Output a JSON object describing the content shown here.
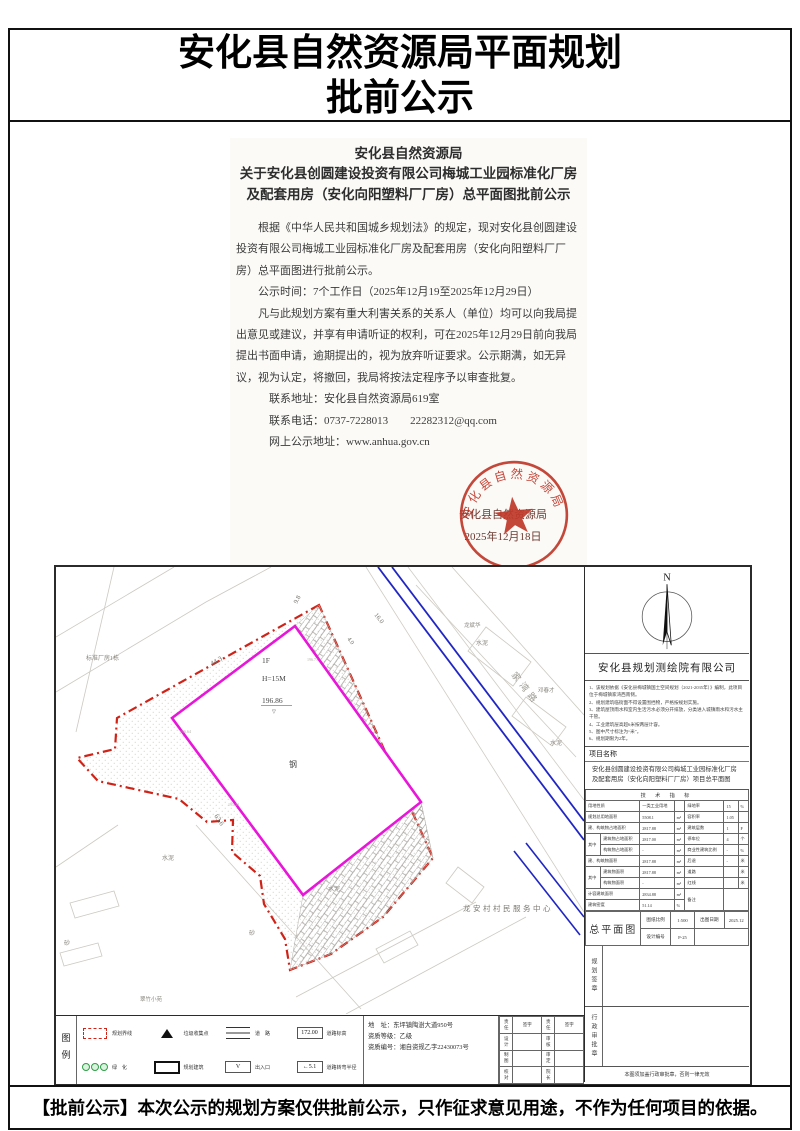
{
  "colors": {
    "magenta": "#e816d8",
    "boundary_red": "#d02318",
    "road_blue": "#2026c4",
    "seal_red": "#c0392b"
  },
  "page": {
    "title_line1": "安化县自然资源局平面规划",
    "title_line2": "批前公示",
    "footer": "【批前公示】本次公示的规划方案仅供批前公示，只作征求意见用途，不作为任何项目的依据。"
  },
  "notice": {
    "org": "安化县自然资源局",
    "subject": "关于安化县创圆建设投资有限公司梅城工业园标准化厂房及配套用房（安化向阳塑料厂厂房）总平面图批前公示",
    "paragraphs": [
      "根据《中华人民共和国城乡规划法》的规定，现对安化县创圆建设投资有限公司梅城工业园标准化厂房及配套用房（安化向阳塑料厂厂房）总平面图进行批前公示。",
      "公示时间：7个工作日（2025年12月19至2025年12月29日）",
      "凡与此规划方案有重大利害关系的关系人（单位）均可以向我局提出意见或建议，并享有申请听证的权利，可在2025年12月29日前向我局提出书面申请，逾期提出的，视为放弃听证要求。公示期满，如无异议，视为认定，将撤回，我局将按法定程序予以审查批复。"
    ],
    "contact_address": "联系地址：安化县自然资源局619室",
    "contact_phone": "联系电话：0737-7228013　　22282312@qq.com",
    "online_url": "网上公示地址：www.anhua.gov.cn",
    "issuer": "安化县自然资源局",
    "date": "2025年12月18日",
    "seal_text": "安化县自然资源局"
  },
  "plan": {
    "labels": [
      "1F",
      "H=15M",
      "196.86",
      "钢",
      "水泥",
      "水泥",
      "水泥",
      "水泥",
      "砂",
      "砂",
      "龙安村村民服务中心",
      "标准厂房1栋",
      "翠竹小苑",
      "龙斌华",
      "邓春才",
      "家湾路",
      "44.3",
      "9.8",
      "16.0",
      "4.0",
      "63.6",
      "196.71",
      "196.64",
      "195.23",
      "▽"
    ]
  },
  "titleblock": {
    "north_label": "N",
    "company": "安化县规划测绘院有限公司",
    "notes": [
      "1、该规划依据《安化县梅城镇国土空间规划（2021-2035年）》编制，此项目位于梅城镇家湾西南侧。",
      "2、规划建筑临街面不得设置围挡物，严格按规划实施。",
      "3、建筑屋顶雨水和室内生活污水必须分开排放，分类进入城镇雨水和污水主干管。",
      "4、工业建筑层高超6米按两层计容。",
      "5、图中尺寸标注为“米”。",
      "6、规划期限为2年。"
    ],
    "project_label": "项目名称",
    "project_name": "安化县创圆建设投资有限公司梅城工业园标准化厂房及配套用房（安化向阳塑料厂厂房）项目总平面图",
    "table": {
      "header": "技 术 指 标",
      "qizhong": "其中",
      "left": [
        {
          "l": "用地性质",
          "v": "一类工业用地",
          "u": ""
        },
        {
          "l": "规划总用地面积",
          "v": "5508.1",
          "u": "m²"
        },
        {
          "l": "建、构筑物占地面积",
          "v": "2817.88",
          "u": "m²"
        },
        {
          "l": "建筑物占地面积",
          "v": "2817.00",
          "u": "m²"
        },
        {
          "l": "构筑物占地面积",
          "v": "-",
          "u": "m²"
        },
        {
          "l": "建、构筑物面积",
          "v": "2817.88",
          "u": "m²"
        },
        {
          "l": "建筑物面积",
          "v": "2817.88",
          "u": "m²"
        },
        {
          "l": "构筑物面积",
          "v": "-",
          "u": "m²"
        },
        {
          "l": "计容建筑面积",
          "v": "2834.88",
          "u": "m²"
        },
        {
          "l": "建筑密度",
          "v": "51.14",
          "u": "%"
        }
      ],
      "right": [
        {
          "l": "绿地率",
          "v": "15",
          "u": "%"
        },
        {
          "l": "容积率",
          "v": "1.05",
          "u": ""
        },
        {
          "l": "建筑层数",
          "v": "1",
          "u": "F"
        },
        {
          "l": "停车位",
          "v": "4",
          "u": "个"
        },
        {
          "l": "商业性建筑比例",
          "v": "-",
          "u": "%"
        },
        {
          "l": "后退",
          "v": "-",
          "u": "米"
        },
        {
          "l": "道路",
          "v": "",
          "u": "米"
        },
        {
          "l": "红线",
          "v": "",
          "u": "米"
        },
        {
          "l": "备注",
          "v": "",
          "u": ""
        }
      ]
    },
    "drawing": {
      "name": "总平面图",
      "scale_label": "图纸比例",
      "scale": "1:500",
      "date_label": "出图日期",
      "date": "2025.12",
      "no_label": "设计编号",
      "no": "P-25"
    },
    "plan_seal": "规划签章",
    "admin_seal": "行政审批章",
    "invalid_note": "本图须加盖行政审批章，否则一律无效"
  },
  "legend": {
    "title": "图例",
    "items": [
      {
        "label": "规划界线"
      },
      {
        "label": "绿　化"
      },
      {
        "label": "垃圾收集点"
      },
      {
        "label": "规划建筑"
      },
      {
        "label": "道　路"
      },
      {
        "label": "出入口"
      },
      {
        "label": "道路标高"
      },
      {
        "label": "道路转弯半径"
      }
    ],
    "elev_value": "172.00",
    "radius_value": "←5.1",
    "entrance_glyph": "V",
    "address": "地　址：东坪镇陶澍大道950号",
    "grade": "资质等级：乙级",
    "cert": "资质编号：湘自资规乙字22430073号",
    "signoff": {
      "headers": [
        "责任",
        "签字",
        "责任",
        "签字"
      ],
      "rows": [
        [
          "设计",
          "",
          "审核",
          ""
        ],
        [
          "制图",
          "",
          "审定",
          ""
        ],
        [
          "校对",
          "",
          "院长",
          ""
        ]
      ]
    }
  }
}
